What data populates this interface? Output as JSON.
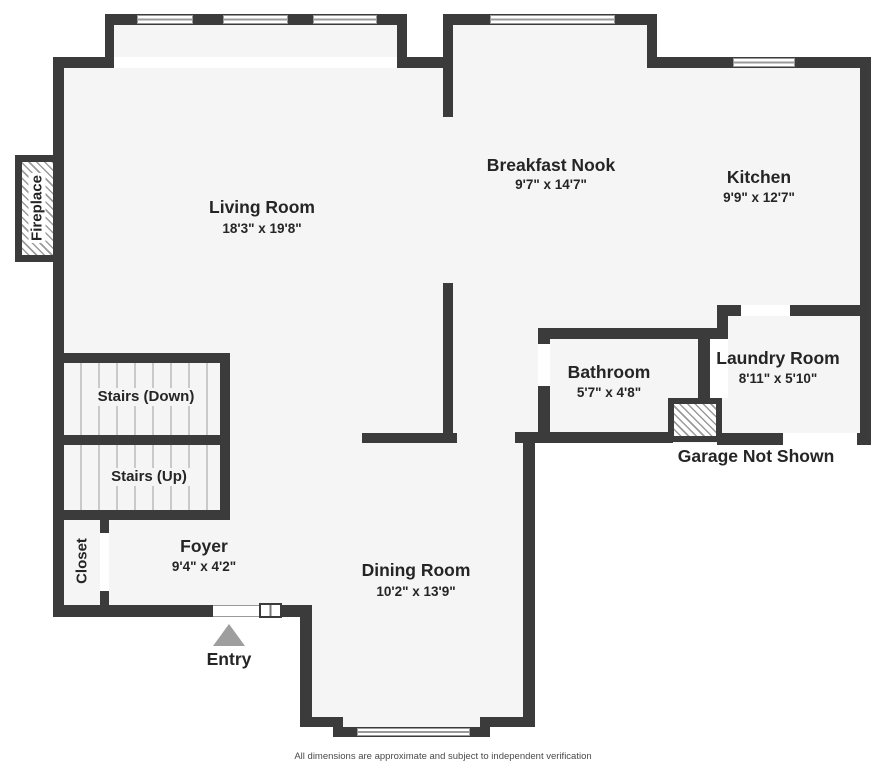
{
  "rooms": {
    "living": {
      "name": "Living Room",
      "dims": "18'3\" x 19'8\""
    },
    "breakfast_nook": {
      "name": "Breakfast Nook",
      "dims": "9'7\" x 14'7\""
    },
    "kitchen": {
      "name": "Kitchen",
      "dims": "9'9\" x 12'7\""
    },
    "bathroom": {
      "name": "Bathroom",
      "dims": "5'7\" x 4'8\""
    },
    "laundry": {
      "name": "Laundry Room",
      "dims": "8'11\" x 5'10\""
    },
    "dining": {
      "name": "Dining Room",
      "dims": "10'2\" x 13'9\""
    },
    "foyer": {
      "name": "Foyer",
      "dims": "9'4\" x 4'2\""
    }
  },
  "features": {
    "stairs_down": "Stairs (Down)",
    "stairs_up": "Stairs (Up)",
    "closet": "Closet",
    "fireplace": "Fireplace",
    "entry": "Entry",
    "garage_note": "Garage Not Shown"
  },
  "footer": {
    "disclaimer": "All dimensions are approximate and subject to independent verification"
  },
  "colors": {
    "wall": "#3b3b3b",
    "floor": "#f5f5f5",
    "background": "#ffffff",
    "window": "#ffffff",
    "tread_line": "#c9c9c9",
    "hatch_line": "#9b9b9b",
    "entry_arrow": "#9e9e9e",
    "text": "#252525",
    "footer_text": "#4a4a4a"
  }
}
